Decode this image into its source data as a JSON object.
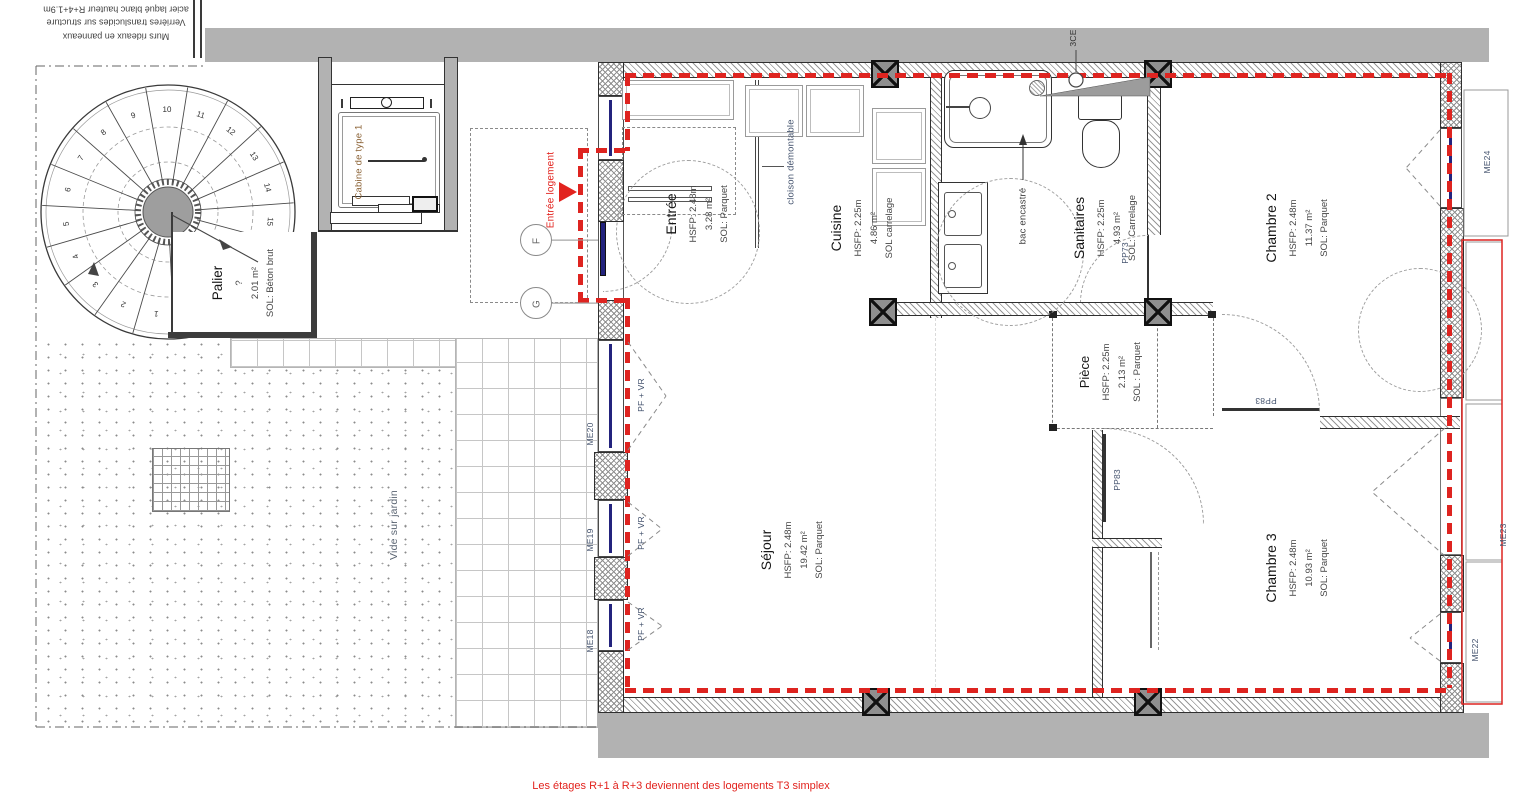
{
  "colors": {
    "red": "#e2231e",
    "navy": "#23237d",
    "wall_gray": "#b2b2b2",
    "label_blue": "#44536e"
  },
  "notes": {
    "top_left_line1": "Murs rideaux en panneaux",
    "top_left_line2": "Verrières translucides sur structure",
    "top_left_line3": "acier laqué blanc hauteur R+4+1.9m",
    "footer": "Les étages R+1 à R+3 deviennent des logements T3 simplex",
    "entry": "Entrée logement",
    "partition": "cloison démontable",
    "tub": "bac encastré",
    "duct": "3CE",
    "garden": "Vide sur jardin"
  },
  "elevator": {
    "label": "Cabine de type 1"
  },
  "landing": {
    "name": "Palier",
    "level": "?",
    "area": "2.01 m²",
    "floor": "SOL: Béton brut"
  },
  "rooms": [
    {
      "name": "Entrée",
      "hsfp": "HSFP: 2.48m",
      "area": "3.28 m²",
      "floor": "SOL: Parquet"
    },
    {
      "name": "Cuisine",
      "hsfp": "HSFP: 2.25m",
      "area": "4.86 m²",
      "floor": "SOL carrelage"
    },
    {
      "name": "Sanitaires",
      "hsfp": "HSFP: 2.25m",
      "area": "4.93 m²",
      "floor": "SOL: Carrelage"
    },
    {
      "name": "Chambre 2",
      "hsfp": "HSFP: 2.48m",
      "area": "11.37 m²",
      "floor": "SOL: Parquet"
    },
    {
      "name": "Pièce",
      "hsfp": "HSFP: 2.25m",
      "area": "2.13 m²",
      "floor": "SOL : Parquet"
    },
    {
      "name": "Séjour",
      "hsfp": "HSFP: 2.48m",
      "area": "19.42 m²",
      "floor": "SOL: Parquet"
    },
    {
      "name": "Chambre 3",
      "hsfp": "HSFP: 2.48m",
      "area": "10.93 m²",
      "floor": "SOL: Parquet"
    }
  ],
  "windows": {
    "me18": "ME18",
    "me19": "ME19",
    "me20": "ME20",
    "me22": "ME22",
    "me23": "ME23",
    "me24": "ME24",
    "pf_vr": "PF + VR"
  },
  "doors": {
    "pp73": "PP73",
    "pp83": "PP83"
  },
  "axes": {
    "f": "F",
    "g": "G"
  },
  "stairs": {
    "steps": [
      "1",
      "2",
      "3",
      "4",
      "5",
      "6",
      "7",
      "8",
      "9",
      "10",
      "11",
      "12",
      "13",
      "14",
      "15"
    ]
  }
}
